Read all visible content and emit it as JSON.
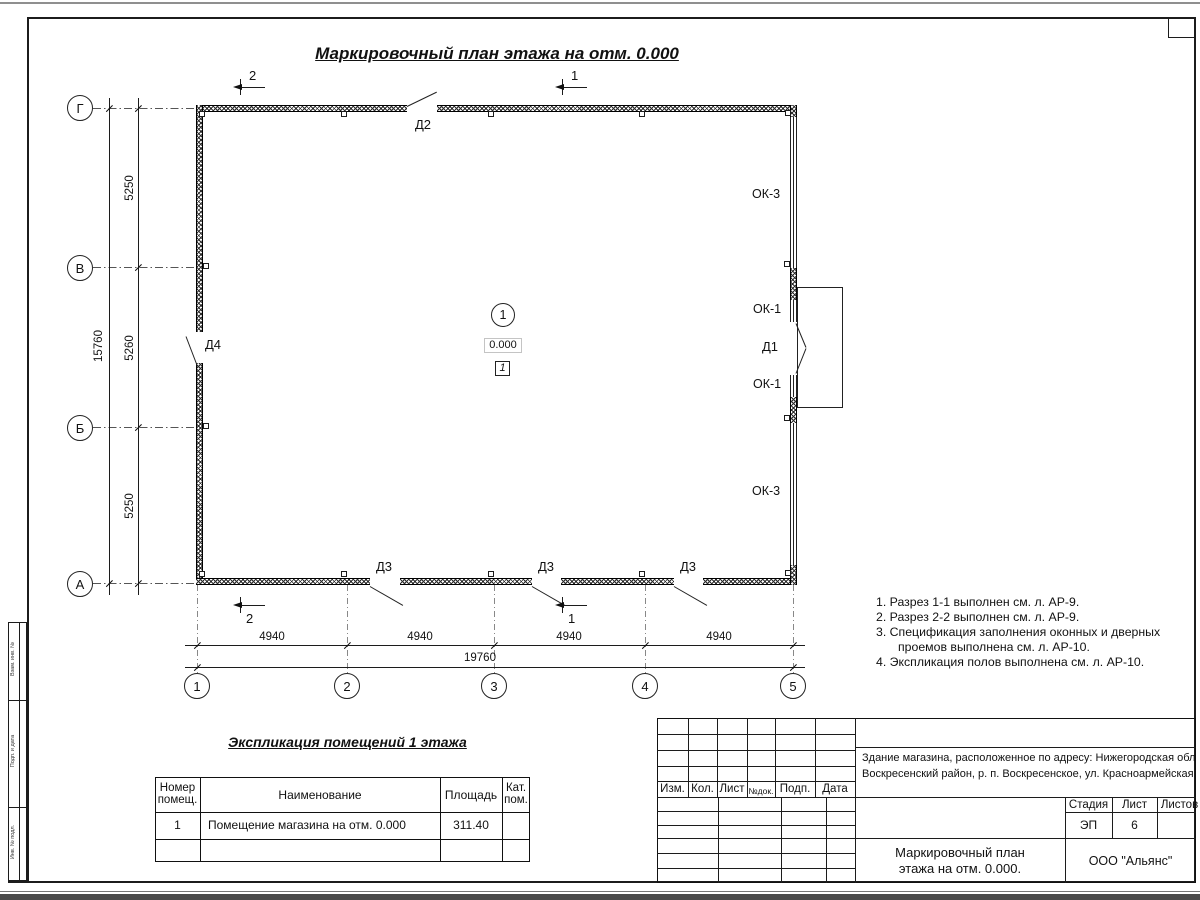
{
  "sheet": {
    "title": "Маркировочный план этажа на отм. 0.000"
  },
  "plan": {
    "room_circle": "1",
    "elevation": "0.000",
    "floor_mark": "1",
    "doors": {
      "d1": "Д1",
      "d2": "Д2",
      "d3": "Д3",
      "d4": "Д4"
    },
    "windows": {
      "ok1": "ОК-1",
      "ok3": "ОК-3"
    },
    "sections": {
      "s1": "1",
      "s2": "2"
    },
    "axes_rows": [
      "Г",
      "В",
      "Б",
      "А"
    ],
    "axes_cols": [
      "1",
      "2",
      "3",
      "4",
      "5"
    ],
    "dims_v": [
      "5250",
      "5260",
      "5250"
    ],
    "dim_v_total": "15760",
    "dims_h": [
      "4940",
      "4940",
      "4940",
      "4940"
    ],
    "dim_h_total": "19760"
  },
  "notes": [
    "1. Разрез 1-1 выполнен см. л. АР-9.",
    "2. Разрез 2-2 выполнен см. л. АР-9.",
    "3. Спецификация заполнения оконных и дверных",
    "проемов выполнена см. л. АР-10.",
    "4. Экспликация полов выполнена см. л. АР-10."
  ],
  "room_table": {
    "title": "Экспликация помещений 1 этажа",
    "col_number_l1": "Номер",
    "col_number_l2": "помещ.",
    "col_name": "Наименование",
    "col_area": "Площадь",
    "col_cat_l1": "Кат.",
    "col_cat_l2": "пом.",
    "row1_number": "1",
    "row1_name": "Помещение магазина на отм. 0.000",
    "row1_area": "311.40"
  },
  "titleblock": {
    "rev_headers": [
      "Изм.",
      "Кол.",
      "Лист",
      "№док.",
      "Подп.",
      "Дата"
    ],
    "project_line1": "Здание магазина, расположенное по адресу: Нижегородская область",
    "project_line2": "Воскресенский район, р. п. Воскресенское, ул. Красноармейская, д. 1",
    "stage_label": "Стадия",
    "sheet_label": "Лист",
    "sheets_label": "Листов",
    "stage_value": "ЭП",
    "sheet_value": "6",
    "doc_title_line1": "Маркировочный план",
    "doc_title_line2": "этажа на отм. 0.000.",
    "company": "ООО \"Альянс\""
  },
  "side_stamp": [
    "Взам. инв. №",
    "Подп. и дата",
    "Инв. № подл."
  ]
}
